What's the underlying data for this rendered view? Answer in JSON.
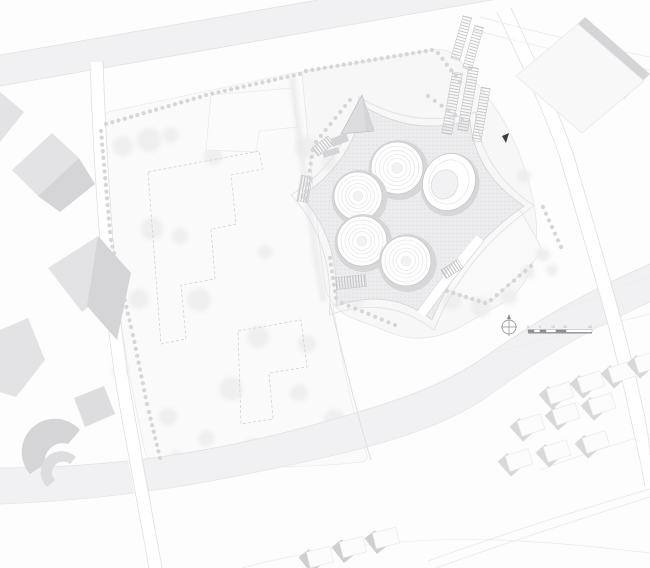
{
  "colors": {
    "background": "#fdfdfd",
    "parcel": "#fafafb",
    "parcel_line": "#ebebed",
    "site_fill": "#f7f7f8",
    "site_line": "#e6e6e8",
    "lawn_fill": "#f9f9fa",
    "lawn_line": "#e4e4e6",
    "road_band": "#f1f1f3",
    "band_edge": "#e2e2e4",
    "road_edge": "#e0e0e2",
    "plaza_fill": "#ececee",
    "plaza_line": "#d8d8da",
    "tower_shadow": "#d7d7d9",
    "tower_stroke": "#c7c7c9",
    "tower_ring": "#e8e8ea",
    "tower_core": "#f2f2f4",
    "tree_dot": "#d6d6d8",
    "canopy": "#eeeeef",
    "building_light": "#e3e3e5",
    "building_dark": "#d5d5d7",
    "building_slab": "#dddddf",
    "building_white": "#f8f8f9",
    "building_white_line": "#e8e8ea",
    "house_white": "#fcfcfd",
    "house_line": "#e9e9eb",
    "house_shadow": "#d8d8da",
    "house_shadow_dark": "#cfcfd1",
    "dash_line": "#cdcdcf",
    "hatch_line": "#c2c2c4",
    "arrow_black": "#3d3d3f",
    "scale_dark": "#8e8e90",
    "scale_text": "#a8a8aa",
    "north": "#9b9b9d",
    "streak": "#e9e9eb"
  },
  "plan": {
    "towers": [
      {
        "cx": 397,
        "cy": 168,
        "r": 26
      },
      {
        "cx": 358,
        "cy": 196,
        "r": 24
      },
      {
        "cx": 362,
        "cy": 241,
        "r": 25
      },
      {
        "cx": 406,
        "cy": 261,
        "r": 25
      }
    ],
    "oval": {
      "cx": 449,
      "cy": 182,
      "rx": 26,
      "ry": 29,
      "rot": 24,
      "irx": 13,
      "iry": 15
    },
    "tree_lines": [
      {
        "x1": 106,
        "y1": 124,
        "x2": 200,
        "y2": 97,
        "n": 16
      },
      {
        "x1": 206,
        "y1": 95,
        "x2": 300,
        "y2": 74,
        "n": 16
      },
      {
        "x1": 306,
        "y1": 71,
        "x2": 432,
        "y2": 50,
        "n": 21
      },
      {
        "x1": 438,
        "y1": 53,
        "x2": 460,
        "y2": 82,
        "n": 6
      },
      {
        "x1": 101,
        "y1": 131,
        "x2": 110,
        "y2": 232,
        "n": 16
      },
      {
        "x1": 111,
        "y1": 240,
        "x2": 131,
        "y2": 327,
        "n": 14
      },
      {
        "x1": 133,
        "y1": 335,
        "x2": 147,
        "y2": 404,
        "n": 11
      },
      {
        "x1": 149,
        "y1": 412,
        "x2": 160,
        "y2": 458,
        "n": 8
      },
      {
        "x1": 305,
        "y1": 198,
        "x2": 313,
        "y2": 150,
        "n": 8
      },
      {
        "x1": 316,
        "y1": 142,
        "x2": 350,
        "y2": 100,
        "n": 8
      },
      {
        "x1": 428,
        "y1": 96,
        "x2": 462,
        "y2": 120,
        "n": 6
      },
      {
        "x1": 330,
        "y1": 258,
        "x2": 336,
        "y2": 298,
        "n": 7
      },
      {
        "x1": 342,
        "y1": 303,
        "x2": 395,
        "y2": 325,
        "n": 9
      },
      {
        "x1": 447,
        "y1": 291,
        "x2": 485,
        "y2": 303,
        "n": 7
      },
      {
        "x1": 491,
        "y1": 300,
        "x2": 531,
        "y2": 266,
        "n": 8
      },
      {
        "x1": 543,
        "y1": 207,
        "x2": 561,
        "y2": 247,
        "n": 7
      }
    ],
    "canopies": [
      [
        123,
        146,
        10
      ],
      [
        149,
        140,
        12
      ],
      [
        171,
        135,
        8
      ],
      [
        228,
        119,
        13
      ],
      [
        213,
        156,
        9
      ],
      [
        306,
        147,
        11
      ],
      [
        330,
        163,
        8
      ],
      [
        152,
        229,
        11
      ],
      [
        180,
        236,
        8
      ],
      [
        139,
        299,
        10
      ],
      [
        199,
        300,
        12
      ],
      [
        258,
        337,
        11
      ],
      [
        307,
        344,
        9
      ],
      [
        231,
        389,
        12
      ],
      [
        299,
        393,
        9
      ],
      [
        334,
        419,
        10
      ],
      [
        357,
        299,
        8
      ],
      [
        265,
        252,
        7
      ],
      [
        120,
        371,
        8
      ],
      [
        168,
        417,
        9
      ],
      [
        206,
        438,
        8
      ],
      [
        253,
        447,
        9
      ],
      [
        297,
        441,
        7
      ],
      [
        176,
        458,
        7
      ],
      [
        214,
        462,
        8
      ],
      [
        258,
        460,
        7
      ],
      [
        306,
        452,
        7
      ],
      [
        452,
        301,
        9
      ],
      [
        481,
        307,
        10
      ],
      [
        509,
        297,
        8
      ],
      [
        528,
        272,
        7
      ],
      [
        437,
        268,
        7
      ],
      [
        543,
        255,
        7
      ],
      [
        552,
        270,
        6
      ],
      [
        524,
        176,
        7
      ]
    ],
    "houses": {
      "rot_se": -18,
      "rot_bottom": -14,
      "se": [
        [
          560,
          393
        ],
        [
          591,
          382
        ],
        [
          622,
          372
        ],
        [
          648,
          362
        ],
        [
          531,
          425
        ],
        [
          566,
          414
        ],
        [
          602,
          404
        ],
        [
          519,
          460
        ],
        [
          557,
          451
        ],
        [
          596,
          442
        ]
      ],
      "bottom": [
        [
          320,
          557
        ],
        [
          353,
          547
        ],
        [
          386,
          538
        ]
      ]
    },
    "left_buildings": [
      {
        "points": "12,170 52,133 79,158 38,196",
        "fill": "building_light"
      },
      {
        "points": "79,158 95,184 60,212 38,196",
        "fill": "building_dark"
      },
      {
        "points": "0,92 24,112 0,142",
        "fill": "building_light"
      },
      {
        "points": "48,268 98,236 131,273 82,312",
        "fill": "building_light"
      },
      {
        "points": "98,236 131,273 117,340 87,306",
        "fill": "building_dark"
      },
      {
        "points": "0,330 28,318 45,360 16,397 0,392",
        "fill": "building_light"
      },
      {
        "points": "74,398 104,386 115,414 85,427",
        "fill": "building_slab"
      }
    ],
    "crescents": [
      {
        "d": "M30,474 A30,30 0 0 1 80,430 L68,444 A18,18 0 0 0 45,464 Z",
        "fill": "building_dark"
      },
      {
        "d": "M47,487 A20,20 0 0 1 76,457 L70,464 A11,11 0 0 0 55,480 Z",
        "fill": "building_slab"
      }
    ],
    "buildings_topright": [
      {
        "points": "585,17 650,74 624,99 559,42",
        "fill": "dark"
      },
      {
        "points": "516,76 578,24 644,81 582,133",
        "fill": "white"
      }
    ],
    "parking": [
      {
        "rot": 10,
        "cx": 462,
        "cy": 105,
        "rects": [
          [
            447,
            74,
            10,
            62
          ],
          [
            462,
            66,
            10,
            64
          ],
          [
            478,
            84,
            9,
            54
          ]
        ]
      },
      {
        "rot": 16,
        "cx": 468,
        "cy": 42,
        "rects": [
          [
            456,
            18,
            9,
            44
          ],
          [
            470,
            24,
            9,
            44
          ]
        ]
      }
    ],
    "stairs": [
      {
        "x": 313,
        "y": 141,
        "w": 20,
        "h": 10,
        "rot": -38
      },
      {
        "x": 299,
        "y": 176,
        "w": 11,
        "h": 26,
        "rot": 10
      },
      {
        "x": 336,
        "y": 276,
        "w": 30,
        "h": 12,
        "rot": -6
      },
      {
        "x": 442,
        "y": 264,
        "w": 20,
        "h": 10,
        "rot": -33
      }
    ],
    "triangle_building": {
      "main": "341,134 362,95 374,131",
      "tip": "362,95 374,131 366,131",
      "bars": [
        "330,139 346,133 349,141 333,147",
        "322,152 338,147 340,153 324,158"
      ]
    }
  },
  "annotations": {
    "entrance_arrow_points": "502,136 509,133 506,143",
    "scale_bar": {
      "segments": [
        [
          528,
          6,
          "dark"
        ],
        [
          534,
          6,
          "light"
        ],
        [
          540,
          6,
          "dark"
        ],
        [
          546,
          10,
          "light"
        ],
        [
          556,
          10,
          "dark"
        ],
        [
          566,
          26,
          "light"
        ]
      ],
      "ticks": [
        {
          "x": 527,
          "label": "0"
        },
        {
          "x": 539,
          "label": "5"
        },
        {
          "x": 551,
          "label": "10"
        },
        {
          "x": 563,
          "label": "20"
        },
        {
          "x": 588,
          "label": "40"
        }
      ]
    }
  }
}
